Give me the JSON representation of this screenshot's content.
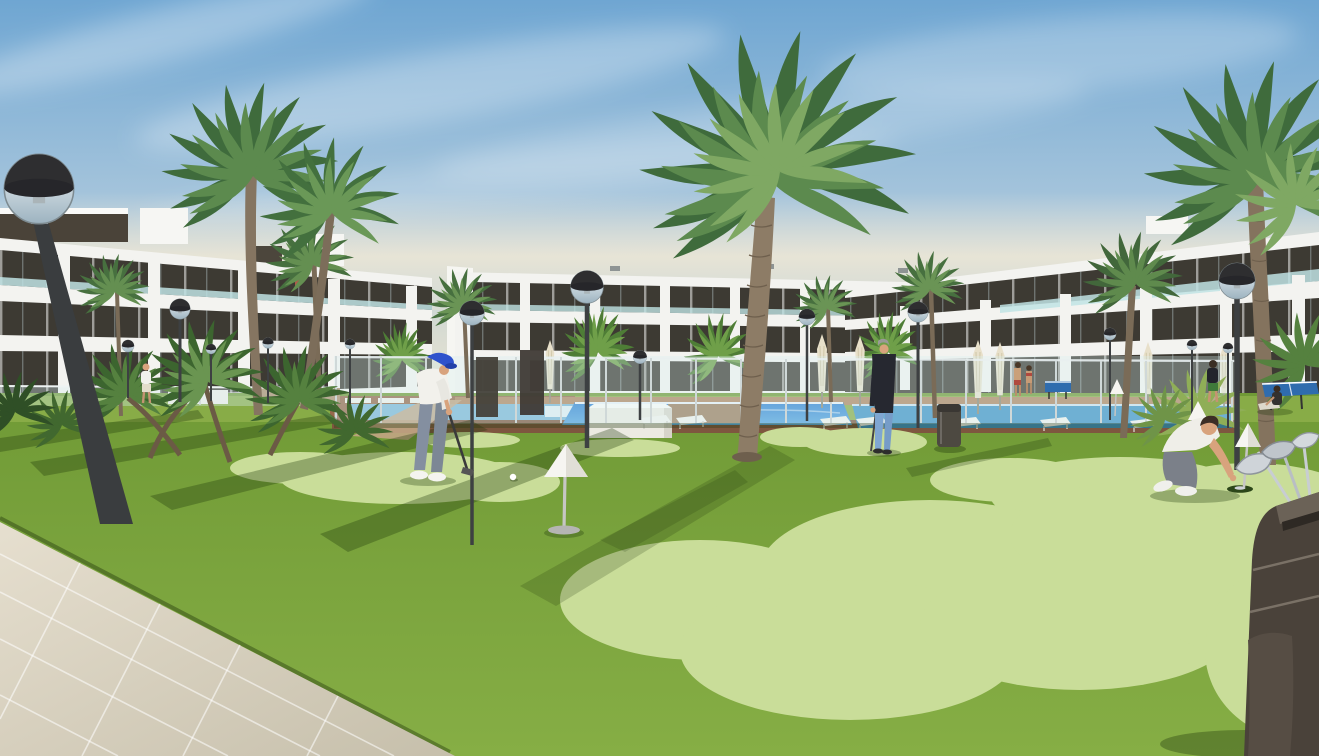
{
  "scene": {
    "description": "3D architectural rendering of a modern white apartment resort: three apartment blocks, palm trees, globe street lamps, a glass-fenced swimming pool with sun loungers and closed umbrellas, a paved walkway, and a mini-golf putting green where residents play",
    "objects": {
      "buildings": [
        "apartment-block-left",
        "apartment-block-center",
        "apartment-block-right"
      ],
      "people": [
        "golfer-putting",
        "man-standing-with-putter",
        "man-crouching-at-hole",
        "walker-near-left-building",
        "pool-couple",
        "walker-right-lawn",
        "woman-sitting-on-lawn",
        "balcony-figure"
      ],
      "props": [
        "globe-street-lamps",
        "white-cone-hole-markers",
        "golf-ball",
        "golf-bag-with-clubs",
        "sun-loungers",
        "closed-umbrellas",
        "glass-pool-fence",
        "swimming-pool",
        "ping-pong-tables",
        "litter-bin",
        "paved-walkway",
        "putting-green-patches",
        "palm-trees",
        "white-planter",
        "stone-gabion-walls"
      ]
    }
  },
  "colors": {
    "sky_top": "#6fa6d2",
    "sky_mid": "#a8c6dc",
    "sky_low": "#d9dcd2",
    "sky_horizon": "#efe7d2",
    "haze": "#efe8d6",
    "facade_white": "#f3f3f0",
    "band_dark": "#3d3a33",
    "glass_teal": "#bfe3e4",
    "lawn_top": "#709a36",
    "lawn_bottom": "#86ae45",
    "green_patch": "#c9dd99",
    "walk_top": "#e6dfcf",
    "walk_bottom": "#c6bfab",
    "pool_top": "#2f80d2",
    "pool_bottom": "#58a7e0",
    "pool_right": "#3f93c6",
    "pool_pale": "#7db7d8",
    "deck_brown": "#96684a",
    "lamp_cap": "#2e2e30",
    "lamp_glass": "#dde9ee",
    "lamp_pole": "#3d4042",
    "palm_dark": "#3f6b3c",
    "palm_mid": "#5c8a4e",
    "palm_light": "#7fa863",
    "trunk": "#8d7c66",
    "trunk_dark": "#6e5f4d",
    "umbrella": "#e8e0ca",
    "cone_white": "#f6f5f1",
    "pole_silver": "#c6c6c4",
    "skin": "#d8a37d",
    "cap_blue": "#2f52cc",
    "polo_white": "#f2f1ec",
    "pants_gray": "#848fa0",
    "navy_top": "#262830",
    "jeans_blue": "#7fa6d2",
    "shirt_white": "#efeee8",
    "pants_gray2": "#7b8089",
    "bag_dark": "#4a423a",
    "club_silver": "#c8cdd2",
    "bin": "#4d4941",
    "table_blue": "#2f6cae",
    "stone": "#a98a66",
    "gravel": "#c2a584",
    "planter_white": "#eceae2",
    "shadow_green": "rgba(28,52,10,0.32)"
  }
}
